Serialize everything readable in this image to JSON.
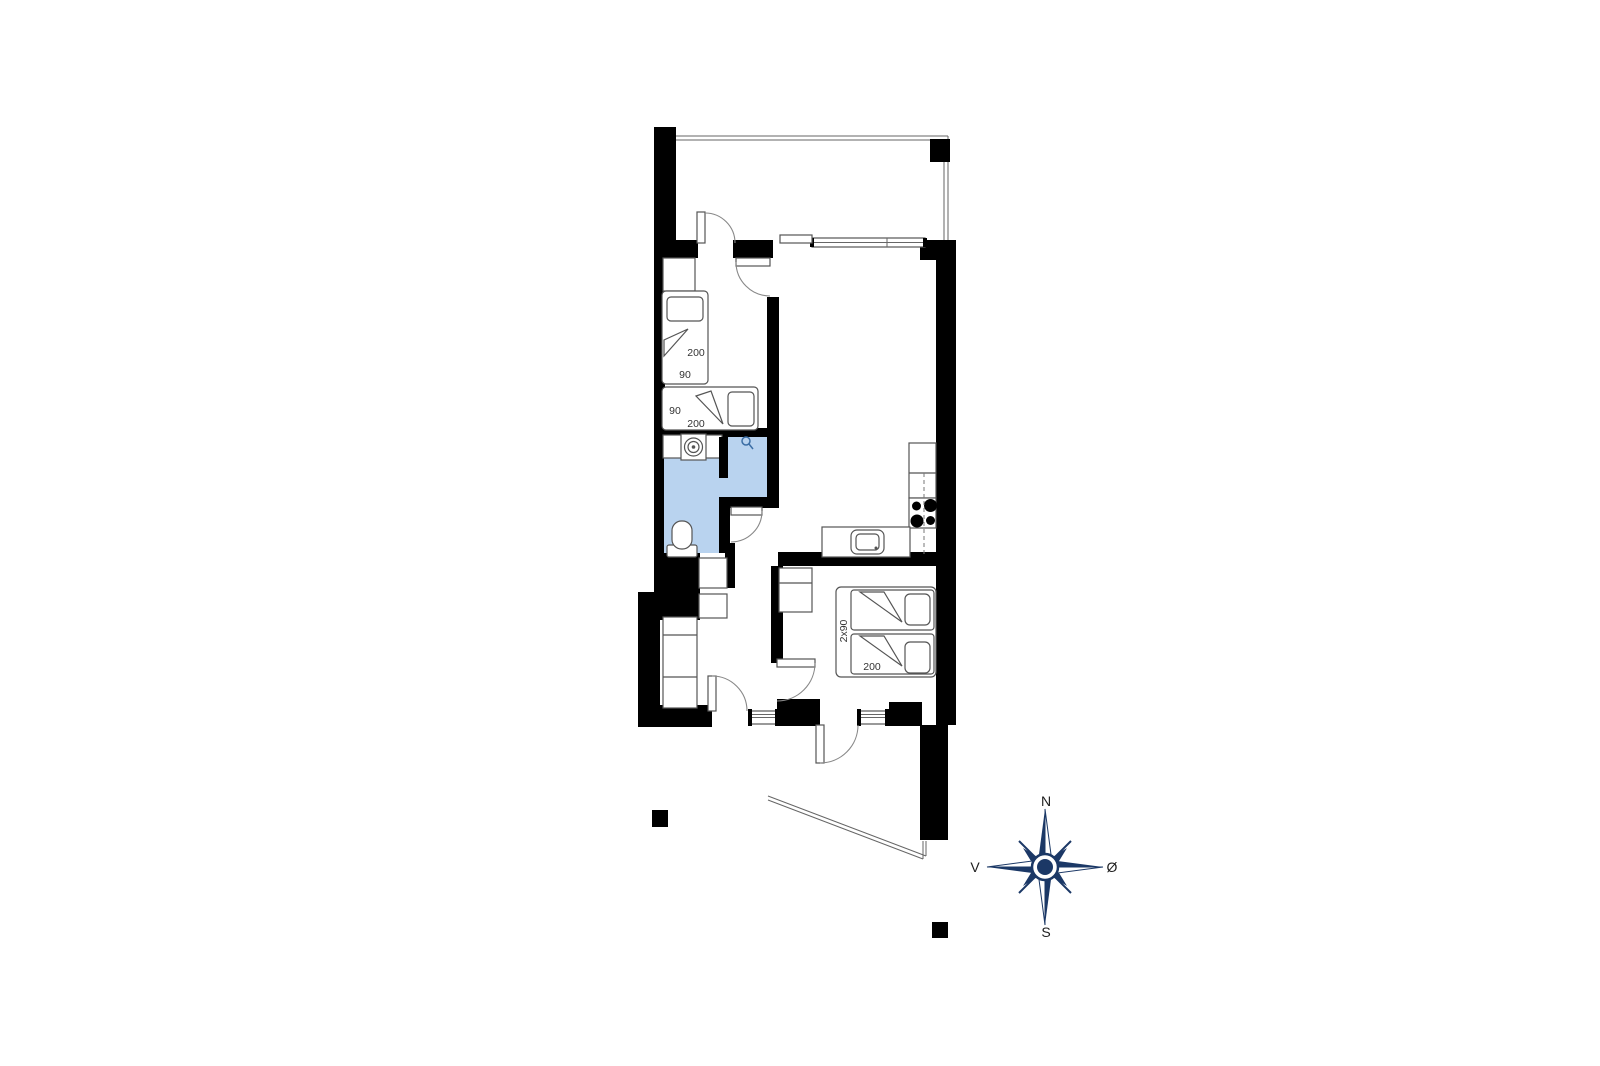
{
  "page": {
    "type": "floor-plan",
    "background": "#ffffff"
  },
  "colors": {
    "wall": "#000000",
    "furniture_outline": "#555555",
    "door_arc": "#888888",
    "bathroom_fill": "#b9d3ef",
    "shower_icon": "#3c6ea5",
    "compass_navy": "#1b3866",
    "label_text": "#333333"
  },
  "labels": {
    "bedroom1_bed1_length": "200",
    "bedroom1_bed1_width": "90",
    "bedroom1_bed2_width": "90",
    "bedroom1_bed2_length": "200",
    "bedroom2_bed_width": "2x90",
    "bedroom2_bed_length": "200"
  },
  "compass": {
    "north": "N",
    "east": "Ø",
    "south": "S",
    "west": "V"
  }
}
